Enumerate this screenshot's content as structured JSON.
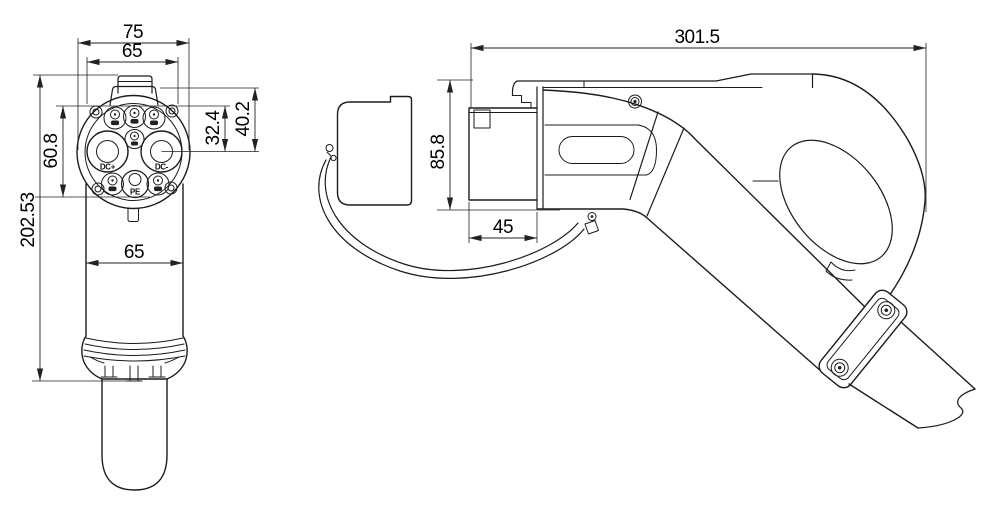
{
  "colors": {
    "background": "#ffffff",
    "line": "#1c1c1c",
    "dimension": "#000000"
  },
  "front_view": {
    "dimensions": {
      "flange_width": "75",
      "face_width": "65",
      "pin_field_height": "60.8",
      "pin_row_to_axis": "32.4",
      "latch_to_axis": "40.2",
      "overall_length": "202.53",
      "body_width": "65"
    },
    "pin_labels": {
      "dc_plus": "DC+",
      "dc_minus": "DC-",
      "pe": "PE"
    }
  },
  "side_view": {
    "dimensions": {
      "overall_length": "301.5",
      "head_height": "85.8",
      "coupler_depth": "45"
    }
  }
}
